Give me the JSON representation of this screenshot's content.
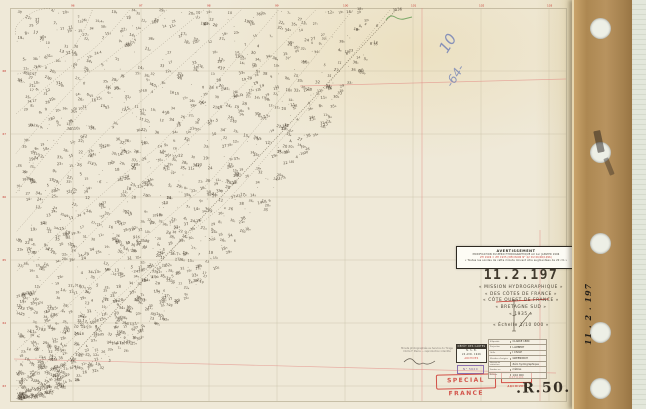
{
  "avertissement": {
    "title": "AVERTISSEMENT",
    "line1": "MODIFICATION DU ZÉRO HYDROGRAPHIQUE AU 1er JANVIER 1996",
    "line2": "ZH 1996 = ZH 1935 (DÉCISION N° 42 DU 06/06/1996)",
    "line3": "« Toutes les sondes de cette minute doivent être augmentées de 20 cm »"
  },
  "title_block": {
    "number": "11.2.197",
    "lines": [
      "« MISSION  HYDROGRAPHIQUE »",
      "« DES  CÔTES  DE  FRANCE »",
      "« CÔTE  OUEST  DE  FRANCE »",
      "« BRETAGNE  SUD »",
      "« 1935 »"
    ],
    "scale": "« Échelle  1/10 000 »"
  },
  "footer": {
    "photo_note": [
      "Minute photographiée au Service du Tirage",
      "Cliché F. Pierre — reproduction interdite"
    ],
    "date_stamp": [
      "DÉPÔT DES CARTES",
      "N. S. B.",
      "24 AVR. 1946",
      "ARCHIVES"
    ],
    "purple_note": "N° 5620",
    "special_france": "SPECIAL FRANCE",
    "retour_stamp": "RETOUR ARCHIVES",
    "geodesy_table": [
      {
        "label": "Ellipsoïde",
        "value": "CLARKE 1880"
      },
      {
        "label": "Projection",
        "value": "LAMBERT"
      },
      {
        "label": "Grille",
        "value": "I CIVILE"
      },
      {
        "label": "Méridien d'origine",
        "value": "GREENWICH"
      },
      {
        "label": "Niveau de réduction",
        "value": "Zéro hydrographique"
      },
      {
        "label": "Sondes en",
        "value": "mètres"
      },
      {
        "label": "Échelle",
        "value": "1/10 000"
      }
    ],
    "archive_ref": ".R.50.16."
  },
  "margin": {
    "vertical_text": "11 . 2 . 197"
  },
  "grid": {
    "top_labels": [
      "96",
      "97",
      "98",
      "99",
      "100",
      "101",
      "102",
      "103"
    ],
    "left_labels": [
      "68",
      "67",
      "66",
      "65",
      "64",
      "63"
    ]
  },
  "annotations": {
    "blue_top": "10",
    "blue_main": "-64-"
  },
  "soundings": {
    "seed": 197,
    "count": 1250,
    "dot_count": 320,
    "min": 4,
    "max": 39
  },
  "colors": {
    "ink": "#43392b",
    "grid_red": "#c4352c",
    "stamp_red": "#cf4038",
    "blue_pencil": "#6d84c0",
    "pink_line": "rgba(225,130,125,0.6)"
  }
}
